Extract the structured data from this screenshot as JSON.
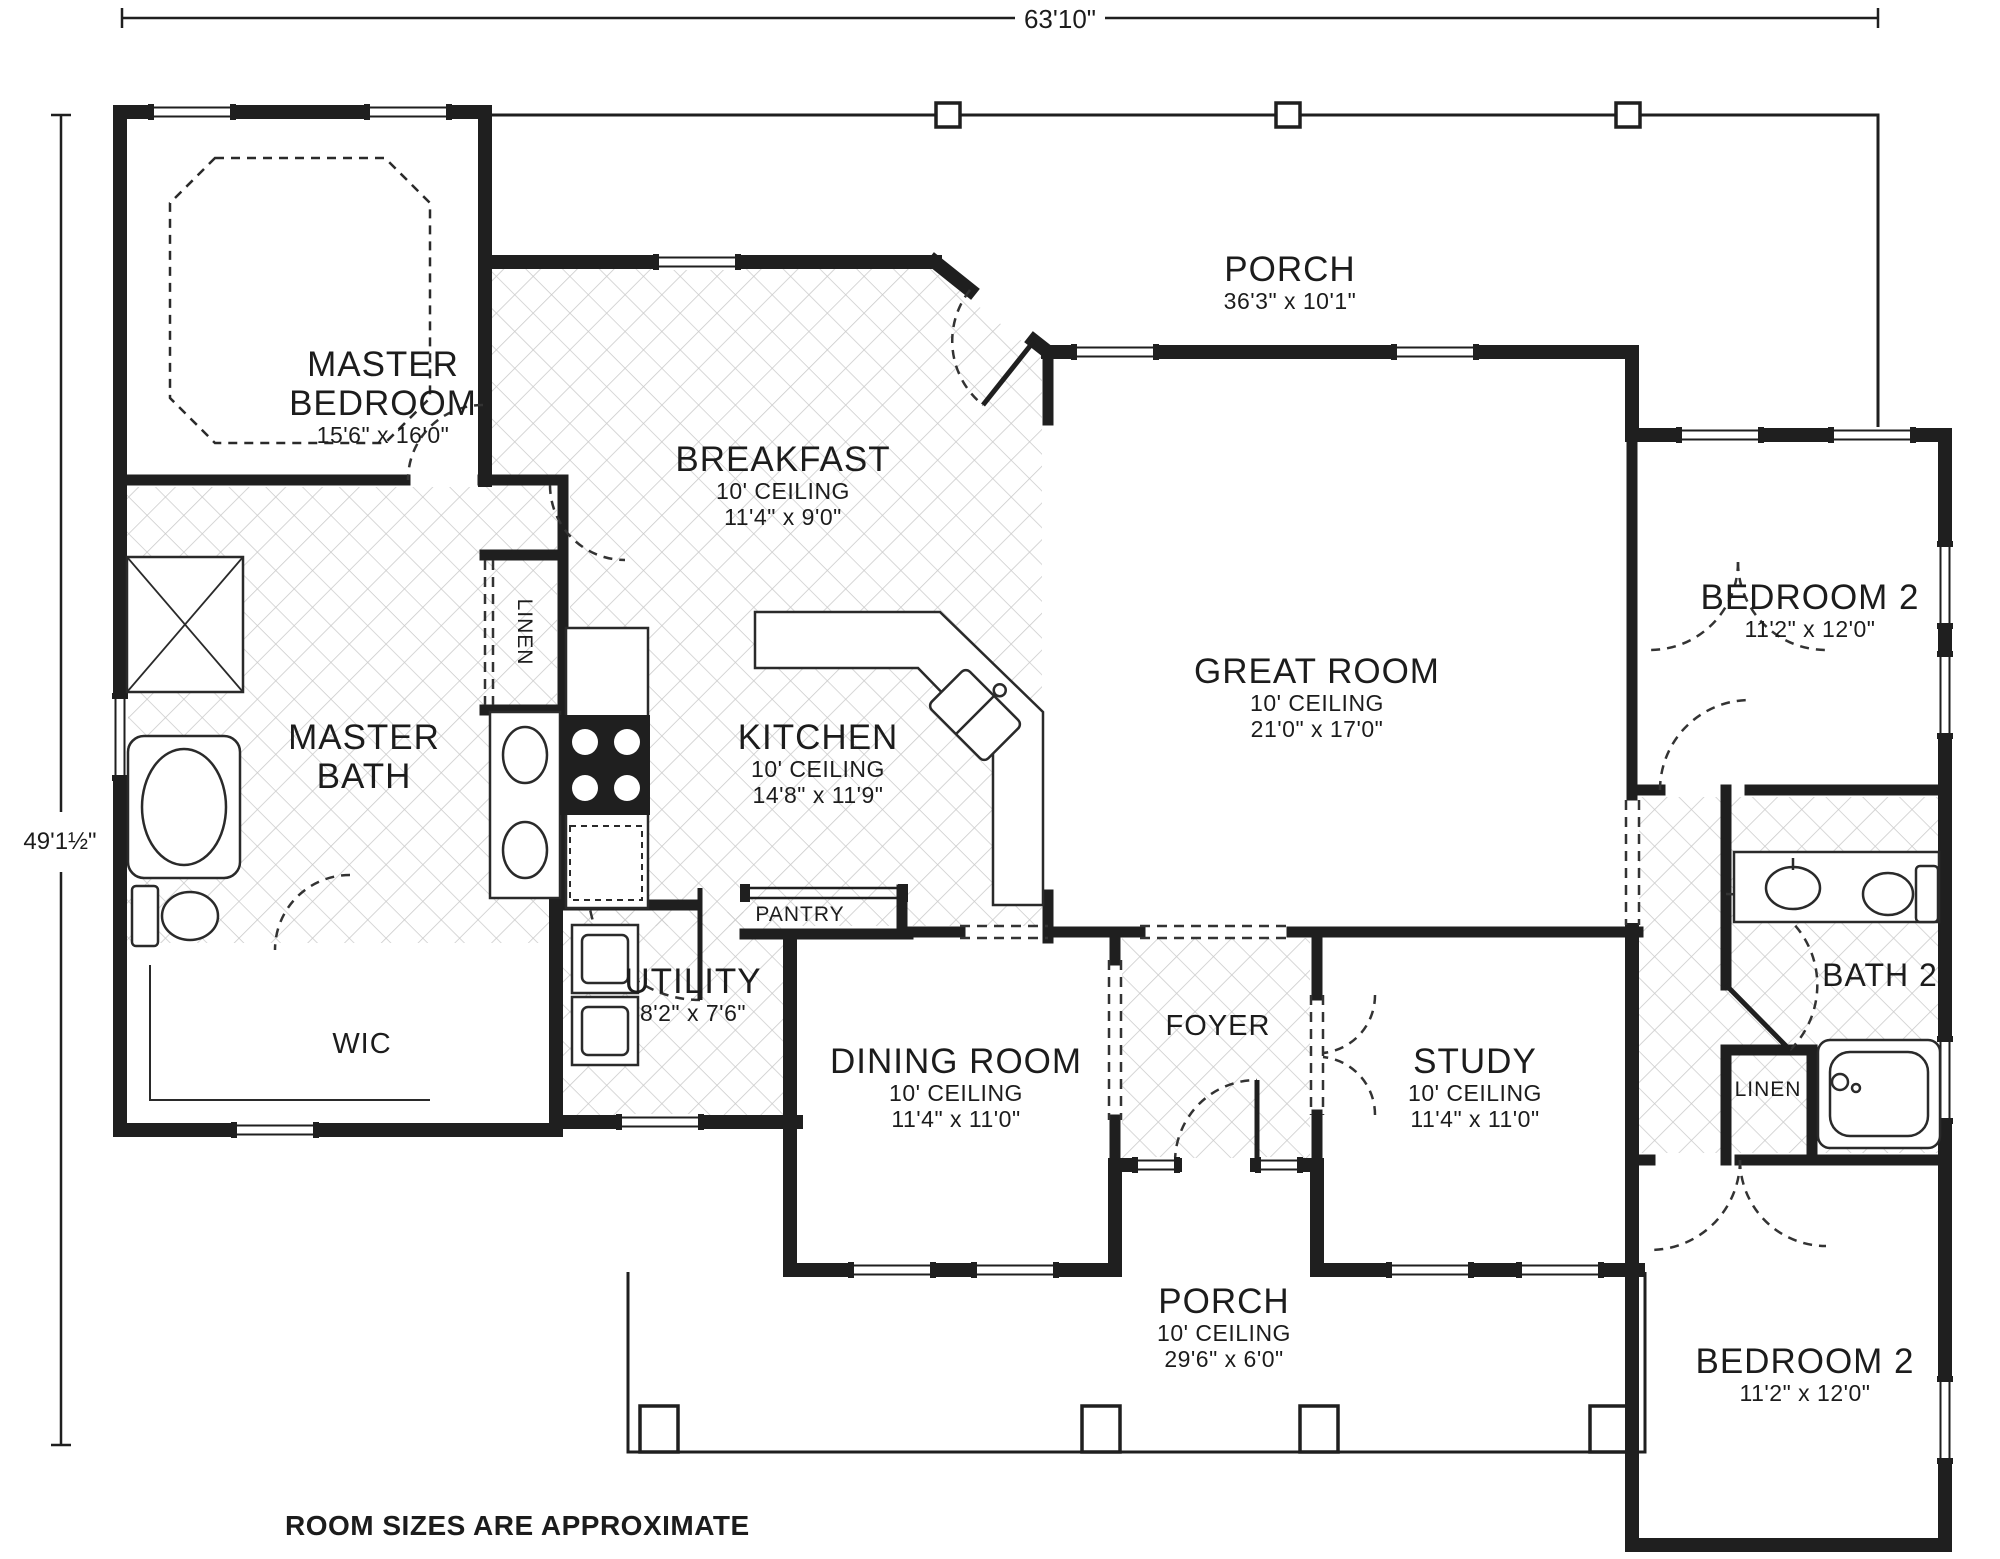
{
  "note": "ROOM SIZES ARE APPROXIMATE",
  "dimensions": {
    "overall_width": "63'10\"",
    "overall_height": "49'1½\""
  },
  "colors": {
    "wall": "#1f1f1f",
    "hatch": "#c9c9c9",
    "background": "#ffffff"
  },
  "rooms": {
    "porch_top": {
      "name": "PORCH",
      "dims": "36'3\" x 10'1\""
    },
    "master_bedroom": {
      "name": "MASTER BEDROOM",
      "dims": "15'6\" x 16'0\""
    },
    "breakfast": {
      "name": "BREAKFAST",
      "ceiling": "10' CEILING",
      "dims": "11'4\" x 9'0\""
    },
    "great_room": {
      "name": "GREAT ROOM",
      "ceiling": "10' CEILING",
      "dims": "21'0\" x 17'0\""
    },
    "bedroom2_upper": {
      "name": "BEDROOM 2",
      "dims": "11'2\" x 12'0\""
    },
    "master_bath": {
      "name": "MASTER BATH"
    },
    "kitchen": {
      "name": "KITCHEN",
      "ceiling": "10' CEILING",
      "dims": "14'8\" x 11'9\""
    },
    "linen_master": {
      "name": "LINEN"
    },
    "pantry": {
      "name": "PANTRY"
    },
    "utility": {
      "name": "UTILITY",
      "dims": "8'2\" x 7'6\""
    },
    "wic": {
      "name": "WIC"
    },
    "dining_room": {
      "name": "DINING ROOM",
      "ceiling": "10' CEILING",
      "dims": "11'4\" x 11'0\""
    },
    "foyer": {
      "name": "FOYER"
    },
    "study": {
      "name": "STUDY",
      "ceiling": "10' CEILING",
      "dims": "11'4\" x 11'0\""
    },
    "bath2": {
      "name": "BATH 2"
    },
    "linen2": {
      "name": "LINEN"
    },
    "porch_bottom": {
      "name": "PORCH",
      "ceiling": "10' CEILING",
      "dims": "29'6\" x 6'0\""
    },
    "bedroom2_lower": {
      "name": "BEDROOM 2",
      "dims": "11'2\" x 12'0\""
    }
  }
}
